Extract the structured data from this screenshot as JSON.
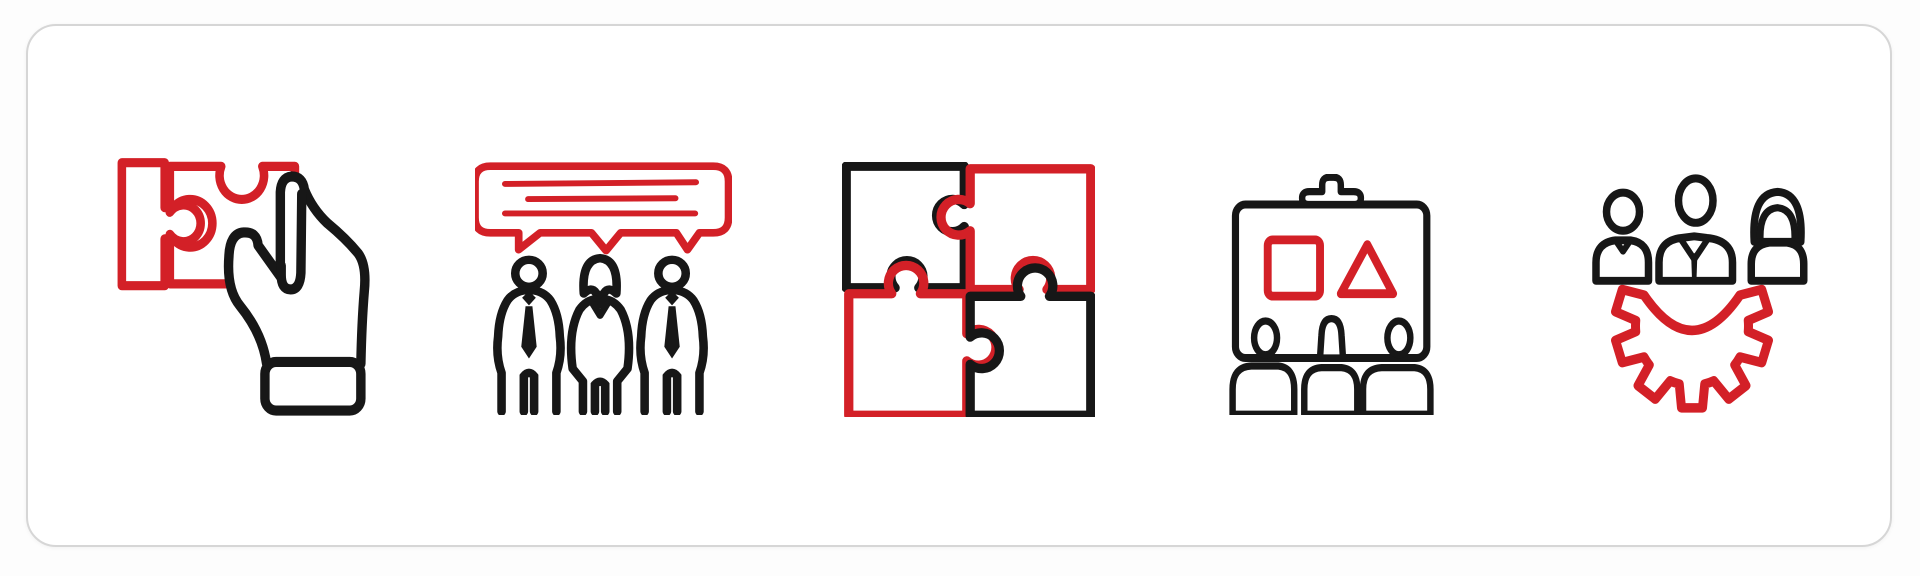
{
  "page": {
    "description": "Business teamwork icon set: five red and black outline icons on a white rounded card",
    "background": "#fdfdfd"
  },
  "card": {
    "background": "#ffffff",
    "border_color": "#d6d6d6",
    "corner_radius_px": 30
  },
  "palette": {
    "primary_red": "#d32027",
    "ink_black": "#171717",
    "white": "#ffffff"
  },
  "icons": [
    {
      "id": "hand-holding-puzzle-piece",
      "label": "Hand holding a jigsaw puzzle piece",
      "colors": "red puzzle piece, black hand"
    },
    {
      "id": "team-communication",
      "label": "Three people under a shared speech bubble with text lines",
      "colors": "red speech bubble, black people"
    },
    {
      "id": "jigsaw-teamwork",
      "label": "Four interlocking jigsaw puzzle pieces",
      "colors": "black top-left and bottom-right pieces, red top-right and bottom-left pieces"
    },
    {
      "id": "business-presentation",
      "label": "Presentation board with clip, square and triangle shapes, and three audience members",
      "colors": "black board and people, red square and triangle"
    },
    {
      "id": "team-management-gear",
      "label": "Three business people above a gear cog",
      "colors": "black people, red gear"
    }
  ]
}
